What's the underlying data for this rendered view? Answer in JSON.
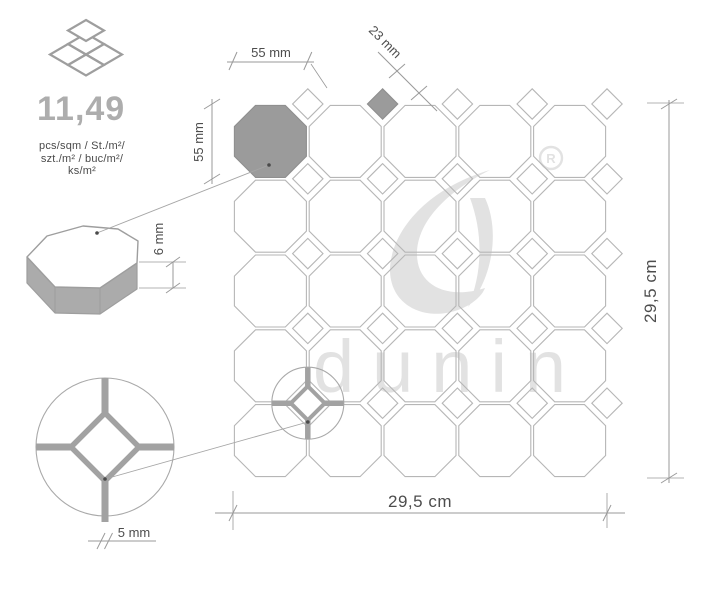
{
  "info": {
    "value": "11,49",
    "units": [
      "pcs/sqm / St./m²/",
      "szt./m² / buc/m²/",
      "ks/m²"
    ]
  },
  "dimensions": {
    "octagon_width": "55 mm",
    "octagon_height": "55 mm",
    "diamond_size": "23 mm",
    "tile_thickness": "6 mm",
    "grout_width": "5 mm",
    "sheet_width": "29,5 cm",
    "sheet_height": "29,5 cm"
  },
  "watermark": {
    "brand": "dunin",
    "registered": "R"
  },
  "pattern": {
    "columns": 5,
    "rows": 5,
    "octagon_tiles": 25,
    "diamond_tiles": 25,
    "highlighted_octagon": {
      "col": 0,
      "row": 0
    },
    "highlighted_diamond": {
      "col": 2,
      "row": 0
    },
    "detail_junction": {
      "col": 1,
      "row": 4
    }
  },
  "colors": {
    "tile_fill": "#9b9b9b",
    "tile_fill_stroke": "#8f8f8f",
    "line": "#b6b6b6",
    "circle": "#a9a9a9",
    "detail": "#a2a2a2",
    "dim_line": "#9a9a9a",
    "dim_text": "#4d4d4d",
    "value_text": "#adadad",
    "units_text": "#4a4a4a",
    "icon": "#9e9e9e",
    "side_fill": "#ababab",
    "watermark": "#e2e2e2",
    "leader": "#a6a6a6",
    "dot": "#4a4a4a"
  }
}
